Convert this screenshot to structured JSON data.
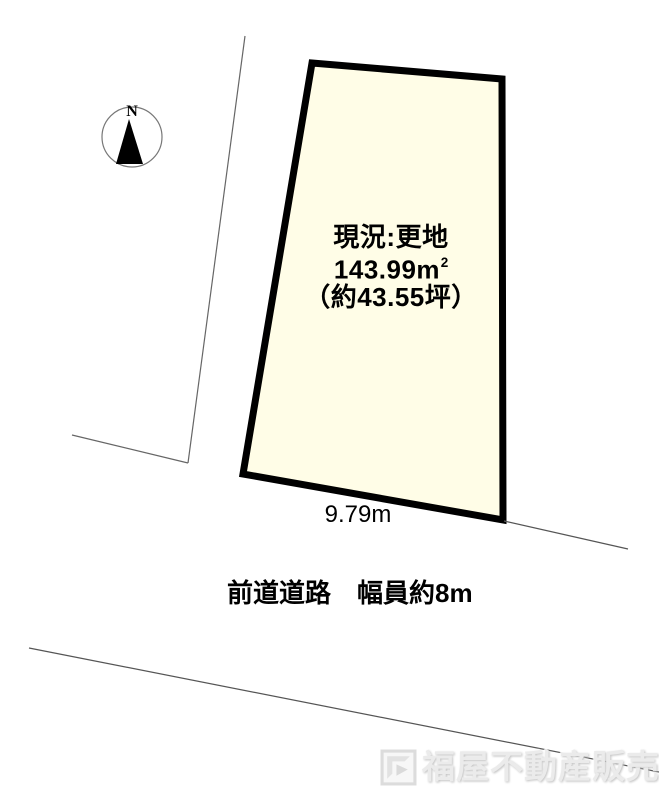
{
  "compass": {
    "north_label": "N"
  },
  "parcel": {
    "status": "現況:更地",
    "area_main": "143.99m",
    "area_sup": "2",
    "area_tsubo": "（約43.55坪）"
  },
  "dimensions": {
    "frontage": "9.79m"
  },
  "road": {
    "label": "前道道路　幅員約8m"
  },
  "watermark": {
    "text": "福屋不動産販売",
    "icon": "fukuya-logo"
  },
  "colors": {
    "parcel-fill": "#FFFDE7",
    "parcel-stroke": "#000000",
    "boundary-line": "#666666",
    "road-line": "#555555",
    "compass-ring": "#777777",
    "compass-needle": "#000000",
    "text": "#000000",
    "watermark": "#ebebeb"
  }
}
